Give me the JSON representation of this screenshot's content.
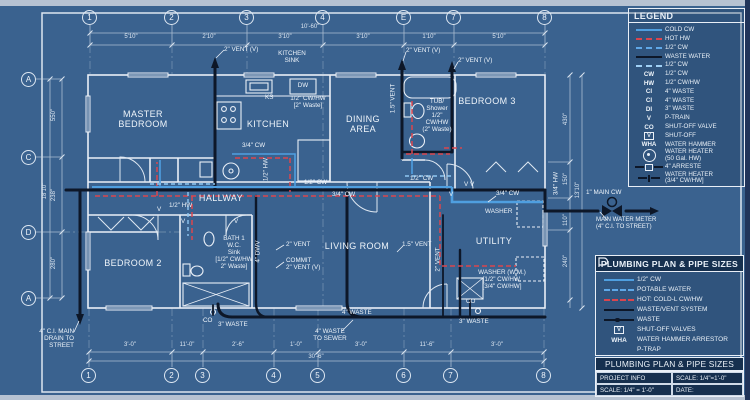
{
  "colors": {
    "background": "#3a628f",
    "wall": "#e9eff7",
    "waste_pipe": "#0d1728",
    "hot_water": "#d9464f",
    "cold_water": "#4f9fe0",
    "cold_water_light": "#8fc7f2",
    "panel_bar": "#16304f"
  },
  "grid": {
    "top": [
      "1",
      "2",
      "3",
      "4",
      "E",
      "7",
      "8"
    ],
    "bottom": [
      "1",
      "2",
      "3",
      "4",
      "5",
      "6",
      "7",
      "8"
    ],
    "left": [
      "A",
      "C",
      "D",
      "A"
    ]
  },
  "dims": {
    "top": [
      "5'10\"",
      "2'10\"",
      "3'10\"",
      "3'10\"",
      "1'10\"",
      "5'10\""
    ],
    "top_overall": "10'-60\"",
    "bottom": [
      "3'-0\"",
      "11'-0\"",
      "2'-6\"",
      "1'-0\"",
      "3'-0\"",
      "11'-6\"",
      "3'-0\""
    ],
    "bottom_overall": "30'-6\"",
    "left": [
      "550\"",
      "238\"",
      "280\""
    ],
    "left_overall": "18'10\"",
    "right": [
      "430\"",
      "150\"",
      "110\"",
      "240\""
    ],
    "right_overall": "13'10\""
  },
  "rooms": {
    "master": "MASTER\nBEDROOM",
    "kitchen": "KITCHEN",
    "dining": "DINING\nAREA",
    "bedroom3": "BEDROOM 3",
    "hallway": "HALLWAY",
    "bedroom2": "BEDROOM 2",
    "living": "LIVING ROOM",
    "utility": "UTILITY"
  },
  "annotations": {
    "vent2v_kitchen": "2\" VENT (V)",
    "kitchen_sink": "KITCHEN\nSINK",
    "ks": "KS",
    "dw": "DW",
    "kitchen_supply": "1/2\" CW/HW\n[2\" Waste]",
    "kitchen_cw": "3/4\" CW",
    "kitchen_hw": "1/2\" HW",
    "vent2v_bath2": "2\" VENT (V)",
    "vent2v_bedroom3": "2\" VENT (V)",
    "vent15_bath2": "1.5\" VENT",
    "tub": "TUB/\nShower\n1/2\"\nCW/HW\n(2\" Waste)",
    "bath2_cw": "1/2\" CW",
    "hall_hw": "1/2\" HW",
    "bath1": "BATH 1\nW.C.\nSink\n[1/2\" CW/HW\n2\" Waste]",
    "dwv": "4\" DWV",
    "vent2_living": "2\" VENT",
    "combo_vent": "COMMIT\n2\" VENT (V)",
    "main_cw_half": "1/2\" CW",
    "main_cw_34": "3/4\" CW",
    "vent15_living": "1.5\" VENT",
    "vent2_utility": "2\" VENT",
    "v": "V",
    "vv": "V V",
    "washer": "WASHER",
    "washer_cw": "3/4\" CW",
    "washer_wm": "WASHER (W.M.)\n[1/2\" CW/HW,\n[3/4\" CW/HW]",
    "co": "CO",
    "waste3_left": "3\" WASTE",
    "waste4": "4\" WASTE",
    "waste3_right": "3\" WASTE",
    "waste_sewer": "4\" WASTE\nTO SEWER",
    "main_drain": "4\" C.I. MAIN\nDRAIN TO\nSTREET",
    "main_cw": "1\" MAIN CW",
    "water_meter": "MAIN WATER METER\n(4\" C.I. TO STREET)",
    "hw34": "3/4\" HW"
  },
  "legend": {
    "title": "LEGEND",
    "items": [
      {
        "sym": "",
        "label": "COLD CW"
      },
      {
        "sym": "",
        "label": "HOT HW"
      },
      {
        "sym": "",
        "label": "1/2\" CW"
      },
      {
        "sym": "",
        "label": "WASTE WATER"
      },
      {
        "sym": "",
        "label": "1/2\" CW"
      },
      {
        "sym": "CW",
        "label": "1/2\" CW"
      },
      {
        "sym": "HW",
        "label": "1/2\" CW/HW"
      },
      {
        "sym": "CI",
        "label": "4\" WASTE"
      },
      {
        "sym": "CI",
        "label": "4\" WASTE"
      },
      {
        "sym": "DI",
        "label": "3\" WASTE"
      },
      {
        "sym": "V",
        "label": "P-TRAIN"
      },
      {
        "sym": "CO",
        "label": "SHUT-OFF VALVE"
      },
      {
        "sym": "V",
        "label": "SHUT-OFF"
      },
      {
        "sym": "WHA",
        "label": "WATER HAMMER"
      },
      {
        "sym": "",
        "label": "WATER HEATER\n(50 Gal. HW)"
      },
      {
        "sym": "",
        "label": "4\" ARRESTE"
      },
      {
        "sym": "",
        "label": "WATER HEATER\n(3/4\" CW/HW]"
      }
    ]
  },
  "pipe_box": {
    "title": "PLUMBING PLAN & PIPE SIZES",
    "items": [
      {
        "sym": "",
        "label": "1/2\" CW"
      },
      {
        "sym": "",
        "label": "POTABLE WATER"
      },
      {
        "sym": "",
        "label": "HOT: COLD-L CW/HW"
      },
      {
        "sym": "",
        "label": "WASTE/VENT SYSTEM"
      },
      {
        "sym": "",
        "label": "WASTE"
      },
      {
        "sym": "V",
        "label": "SHUT-OFF VALVES"
      },
      {
        "sym": "WHA",
        "label": "WATER HAMMER ARRESTOR"
      },
      {
        "sym": "",
        "label": "P-TRAP"
      }
    ],
    "footer": "PLUMBING PLAN & PIPE SIZES",
    "info": {
      "project": "PROJECT INFO",
      "scale_top": "SCALE: 1/4\"=1'-0\"",
      "scale_bottom": "SCALE: 1/4\" = 1'-0\"",
      "date": "DATE:"
    }
  }
}
